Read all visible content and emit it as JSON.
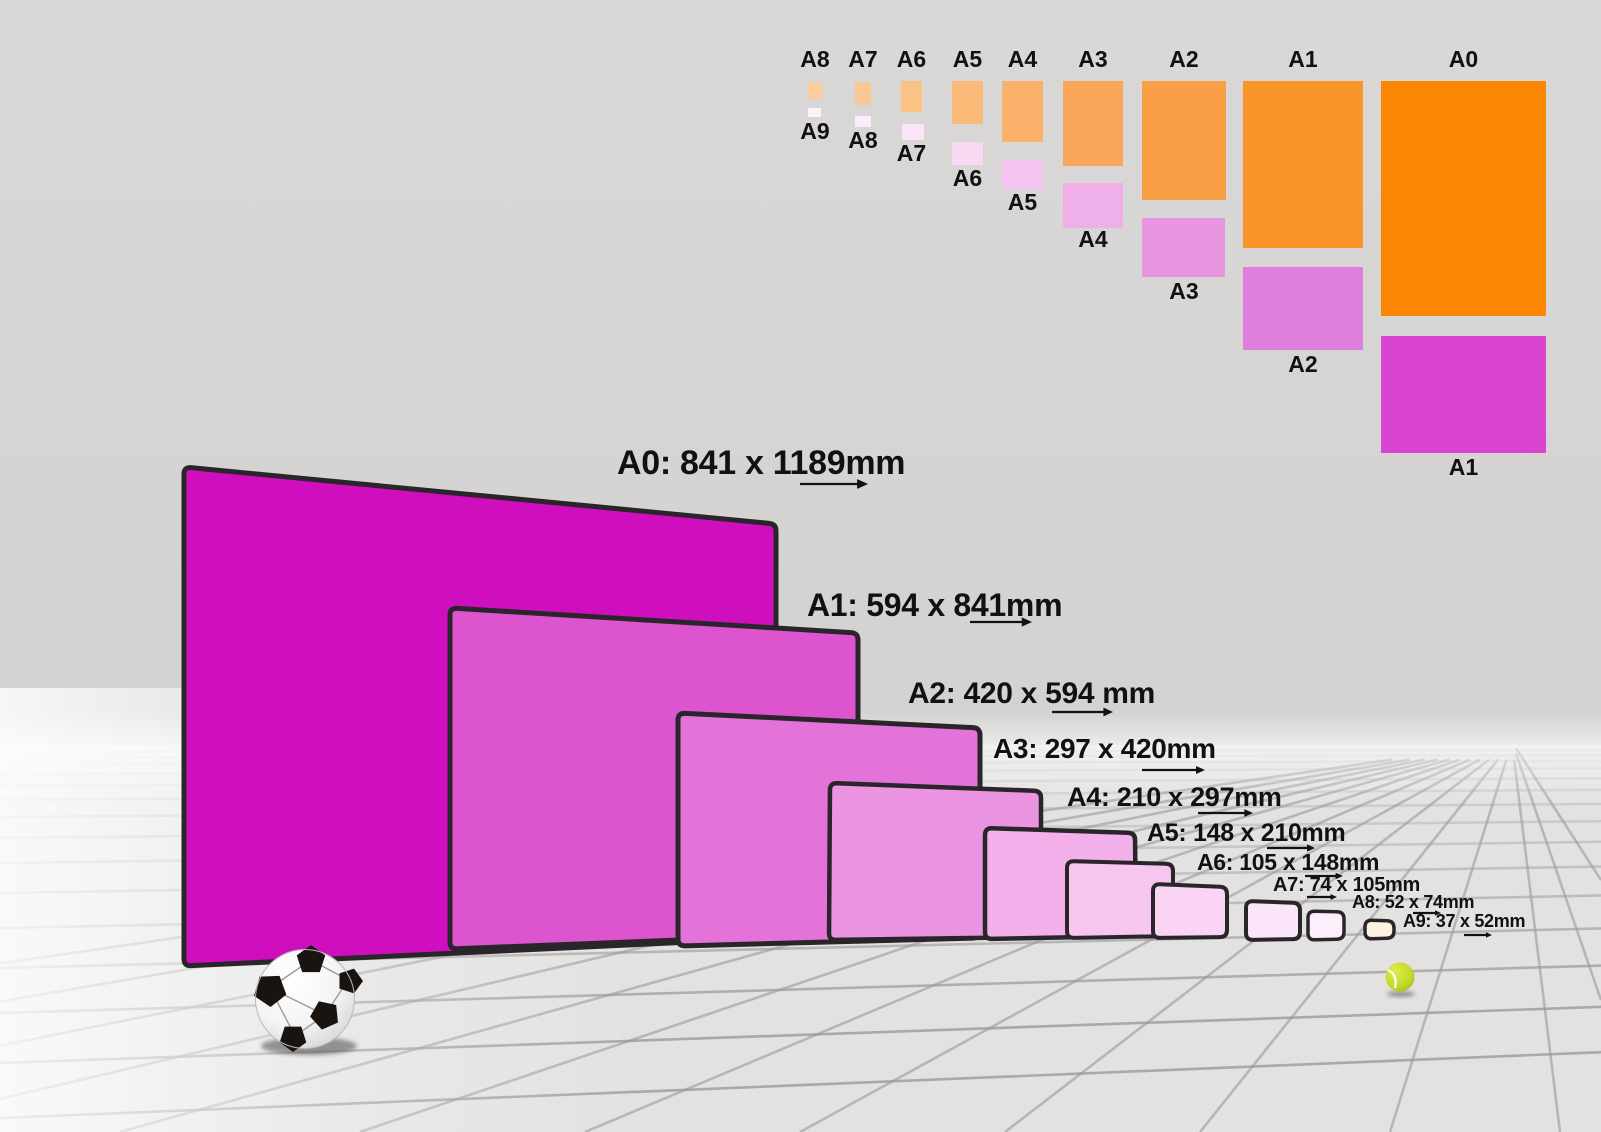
{
  "scene": {
    "wall_color": "#D7D6D5",
    "floor_color": "#E3E2E1",
    "grid_line_color": "#999999",
    "sheet_border_color": "#29252A",
    "label_color": "#111111",
    "objects": [
      "soccer-ball",
      "tennis-ball"
    ],
    "soccer_ball_color": "#FFFFFF",
    "soccer_patch_color": "#1A1410",
    "tennis_ball_color": "#C3D82C"
  },
  "perspective_sheets": [
    {
      "id": "A0",
      "label": "A0: 841 x 1189mm",
      "width_mm": 841,
      "height_mm": 1189,
      "color": "#CF0EBD"
    },
    {
      "id": "A1",
      "label": "A1: 594 x 841mm",
      "width_mm": 594,
      "height_mm": 841,
      "color": "#DC55CE"
    },
    {
      "id": "A2",
      "label": "A2: 420 x 594 mm",
      "width_mm": 420,
      "height_mm": 594,
      "color": "#E373D9"
    },
    {
      "id": "A3",
      "label": "A3: 297 x 420mm",
      "width_mm": 297,
      "height_mm": 420,
      "color": "#EB94E1"
    },
    {
      "id": "A4",
      "label": "A4: 210 x 297mm",
      "width_mm": 210,
      "height_mm": 297,
      "color": "#F3B0EA"
    },
    {
      "id": "A5",
      "label": "A5: 148 x 210mm",
      "width_mm": 148,
      "height_mm": 210,
      "color": "#F7C6F0"
    },
    {
      "id": "A6",
      "label": "A6: 105 x 148mm",
      "width_mm": 105,
      "height_mm": 148,
      "color": "#F9D5F3"
    },
    {
      "id": "A7",
      "label": "A7: 74 x 105mm",
      "width_mm": 74,
      "height_mm": 105,
      "color": "#FBE5F8"
    },
    {
      "id": "A8",
      "label": "A8: 52 x 74mm",
      "width_mm": 52,
      "height_mm": 74,
      "color": "#FCEEFA"
    },
    {
      "id": "A9",
      "label": "A9: 37 x 52mm",
      "width_mm": 37,
      "height_mm": 52,
      "color": "#FBF3E0"
    }
  ],
  "size_chart": {
    "columns": [
      {
        "parent": "A8",
        "parent_color": "#FACD9E",
        "half": "A9",
        "half_color": "#FDF2FC"
      },
      {
        "parent": "A7",
        "parent_color": "#FAC892",
        "half": "A8",
        "half_color": "#FCEBFA"
      },
      {
        "parent": "A6",
        "parent_color": "#FAC285",
        "half": "A7",
        "half_color": "#FBE3F8"
      },
      {
        "parent": "A5",
        "parent_color": "#FABB78",
        "half": "A6",
        "half_color": "#F9D8F4"
      },
      {
        "parent": "A4",
        "parent_color": "#FAB169",
        "half": "A5",
        "half_color": "#F5C3EF"
      },
      {
        "parent": "A3",
        "parent_color": "#F9A85B",
        "half": "A4",
        "half_color": "#EFAFE9"
      },
      {
        "parent": "A2",
        "parent_color": "#F99F47",
        "half": "A3",
        "half_color": "#E795E1"
      },
      {
        "parent": "A1",
        "parent_color": "#F9952B",
        "half": "A2",
        "half_color": "#E07FDB"
      },
      {
        "parent": "A0",
        "parent_color": "#FB8604",
        "half": "A1",
        "half_color": "#D945CE"
      }
    ]
  }
}
